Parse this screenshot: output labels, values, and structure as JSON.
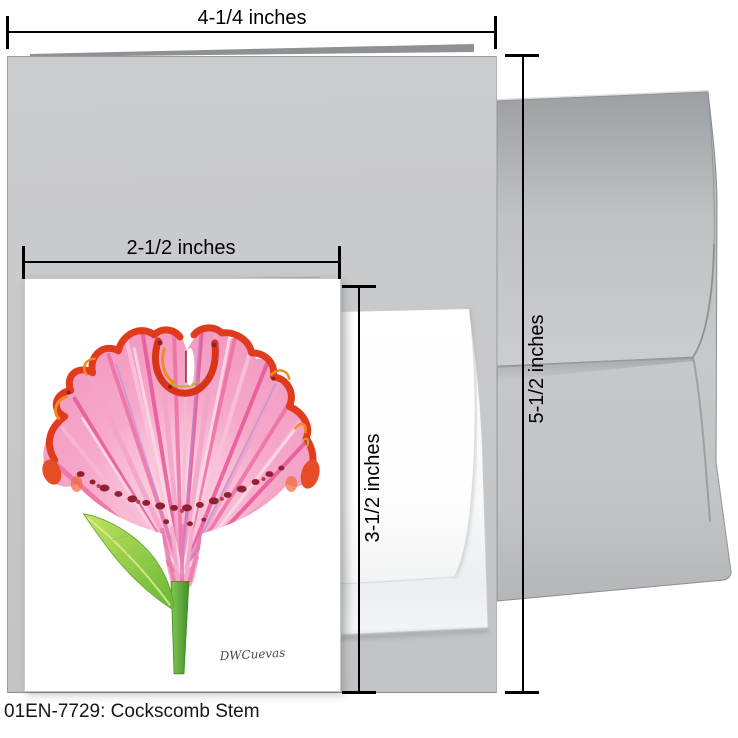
{
  "product": {
    "caption": "01EN-7729: Cockscomb Stem",
    "sku": "01EN-7729",
    "title": "Cockscomb Stem",
    "artwork": {
      "subject": "cockscomb-flower-painting",
      "signature": "DWCuevas"
    }
  },
  "dimensions": {
    "card_width": "4-1/4 inches",
    "card_height": "5-1/2 inches",
    "insert_width": "2-1/2 inches",
    "insert_height": "3-1/2 inches"
  },
  "colors": {
    "card_gray": "#c6c8ca",
    "envelope_gray": "#c3c5c7",
    "small_envelope_white": "#f7f8f9",
    "bloom_pink": "#f0669f",
    "bloom_light_pink": "#f8bcd4",
    "ruffle_red": "#e13a1c",
    "ruffle_orange": "#f08a22",
    "speck_maroon": "#8e2132",
    "stem_green": "#4f9d2e",
    "leaf_green": "#8cc63f",
    "dimension_line": "#000000"
  }
}
